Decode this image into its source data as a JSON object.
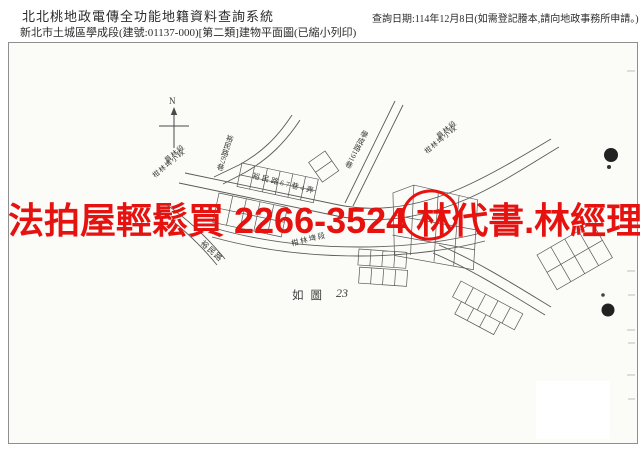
{
  "header": {
    "system_title": "北北桃地政電傳全功能地籍資料查詢系統",
    "document_title": "新北市土城區學成段(建號:01137-000)[第二類]建物平面圖(已縮小列印)",
    "query_date_note": "查詢日期:114年12月8日(如需登記謄本,請向地政事務所申請。)"
  },
  "map": {
    "north_label": "N",
    "roads": {
      "xuecheng_lane_191": "學成路191巷",
      "yumin_lane_67": "裕民路67巷",
      "yumin_lane_67_alley_4": "裕民路67巷4弄",
      "yumin_road": "裕民路",
      "ganlinpi_section_road": "柑林埤段"
    },
    "section_label_line1": "員林段",
    "section_label_line2": "柑林埤小段",
    "caption": "如圖",
    "figure_number": "23"
  },
  "watermark": {
    "text": "法拍屋輕鬆買 2266-3524 林代書.林經理",
    "color": "#e51210"
  }
}
